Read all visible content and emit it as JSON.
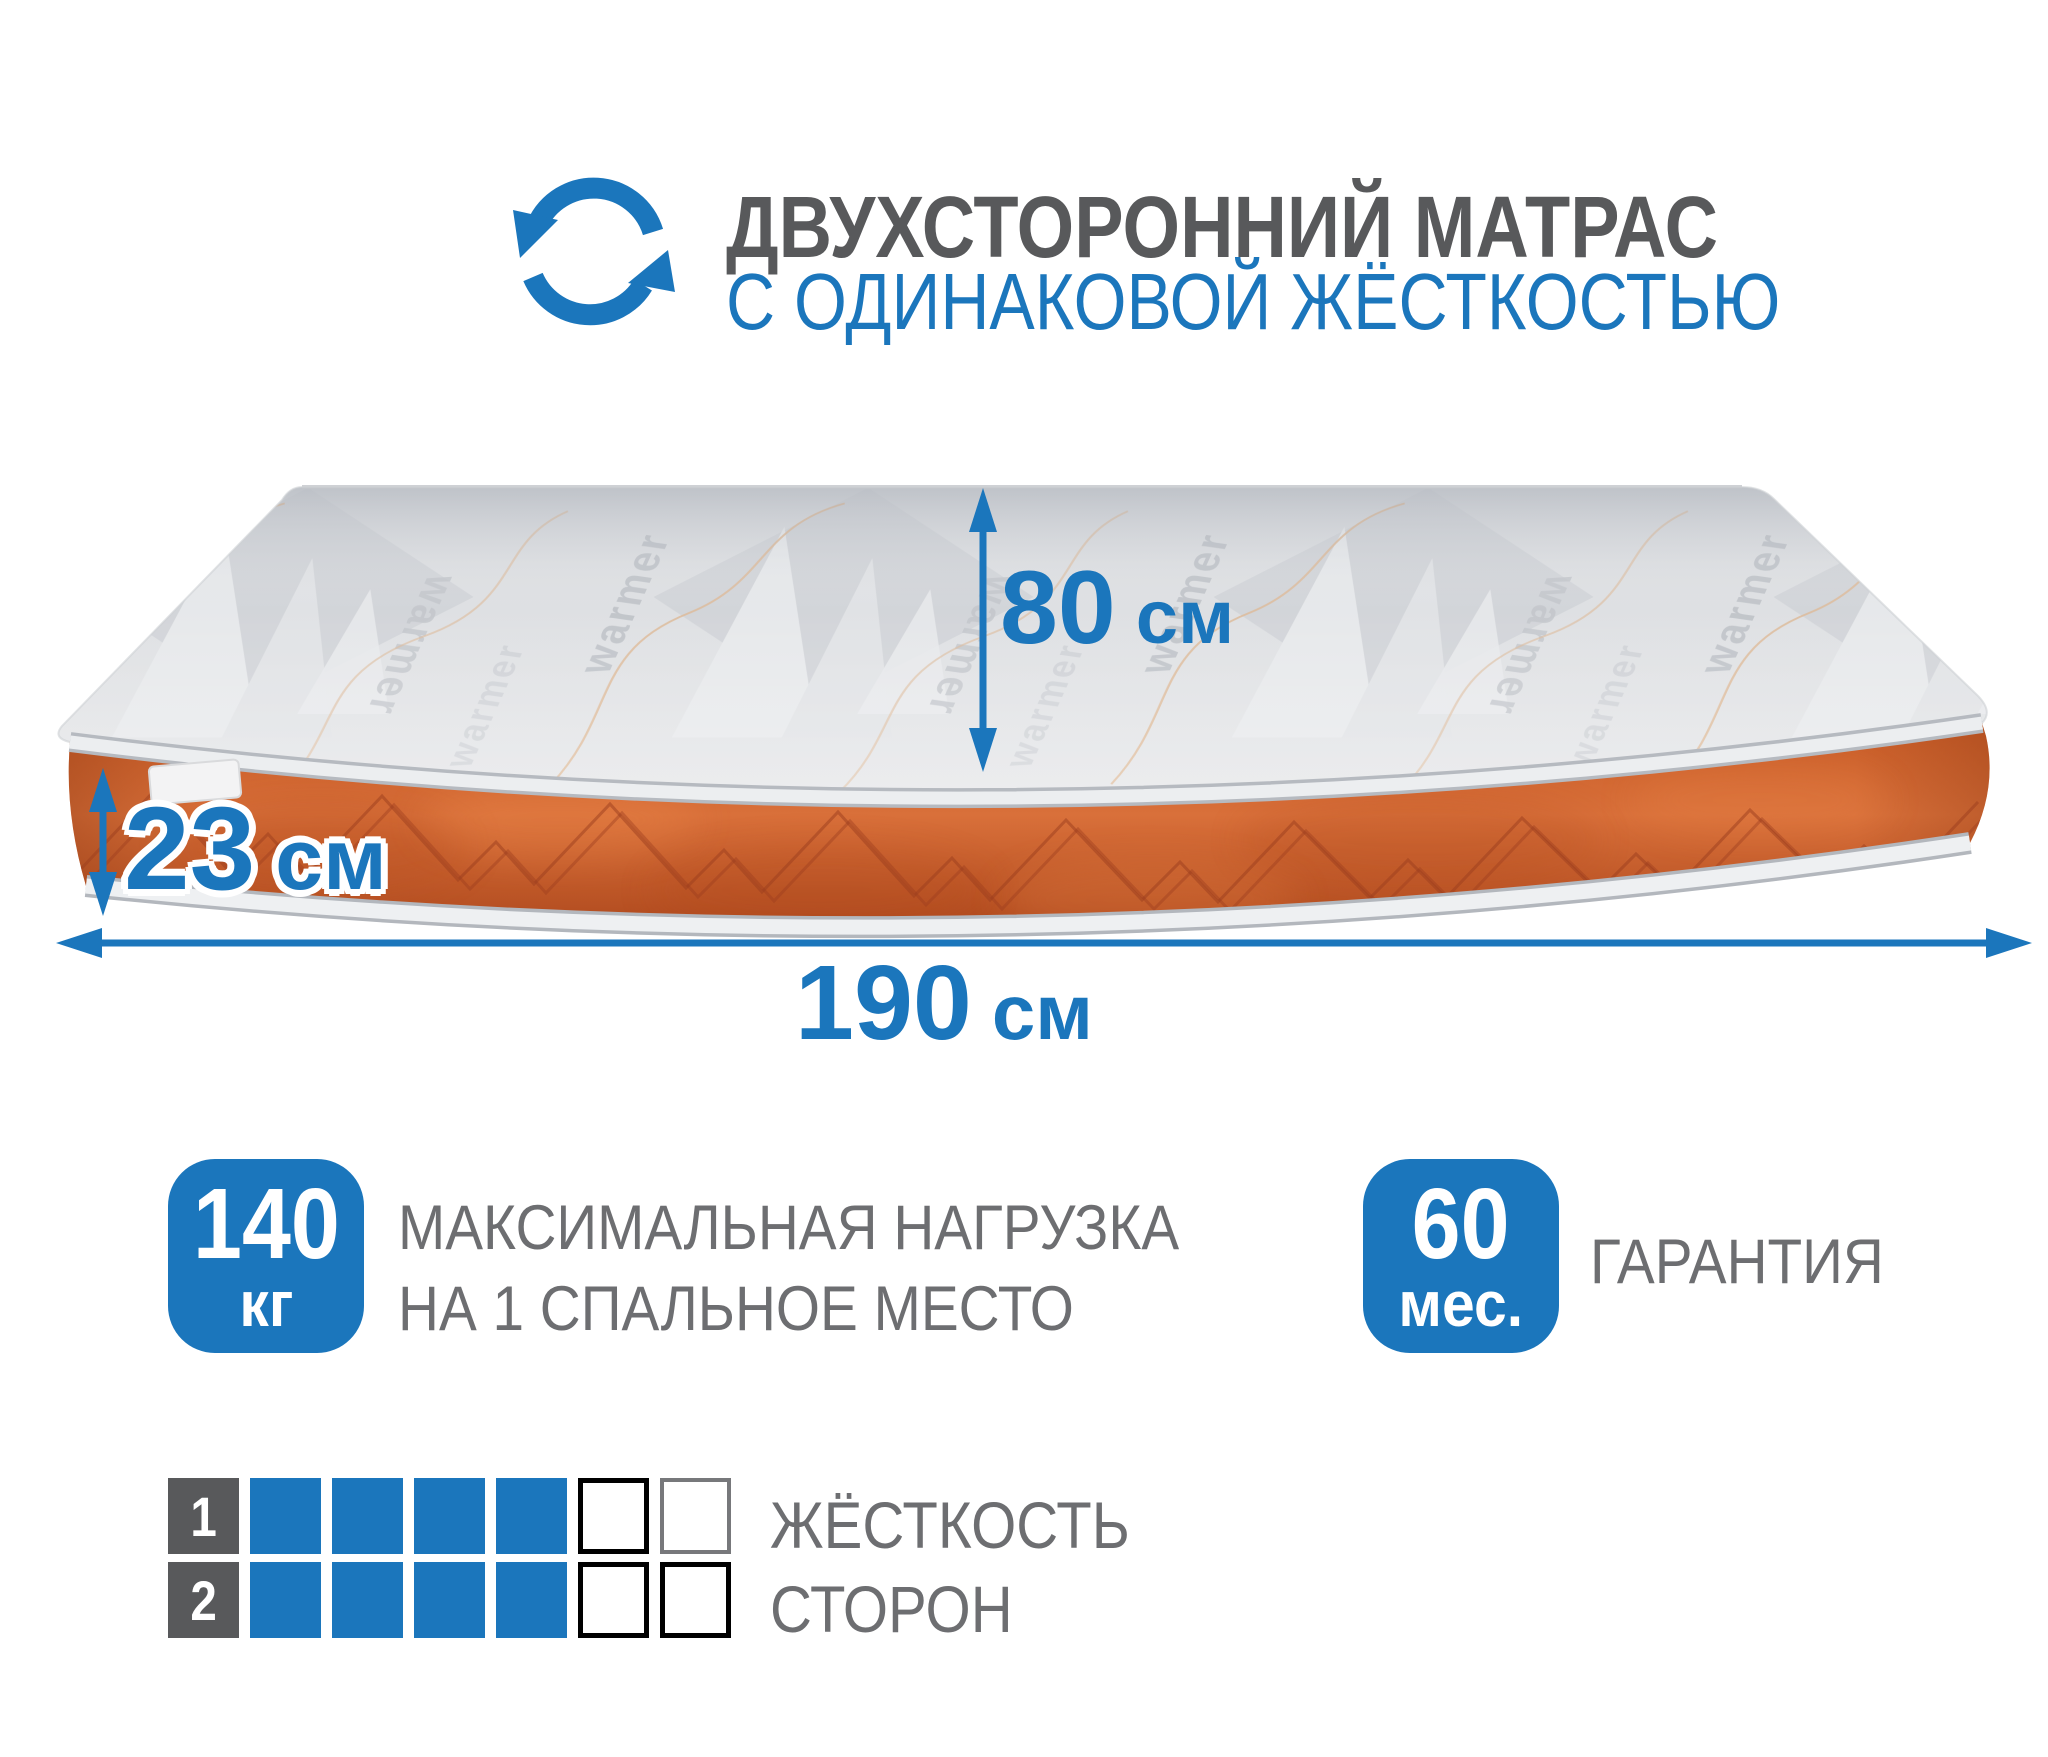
{
  "header": {
    "title": "ДВУХСТОРОННИЙ МАТРАС",
    "subtitle": "С ОДИНАКОВОЙ ЖЁСТКОСТЬЮ"
  },
  "dimensions": {
    "depth": {
      "value": "80",
      "unit": "см"
    },
    "height": {
      "value": "23",
      "unit": "см"
    },
    "length": {
      "value": "190",
      "unit": "см"
    }
  },
  "badges": [
    {
      "value": "140",
      "unit": "кг",
      "label_line1": "МАКСИМАЛЬНАЯ НАГРУЗКА",
      "label_line2": "НА 1 СПАЛЬНОЕ МЕСТО"
    },
    {
      "value": "60",
      "unit": "мес.",
      "label_line1": "ГАРАНТИЯ",
      "label_line2": ""
    }
  ],
  "firmness_scale": {
    "rows": [
      {
        "index": "1",
        "filled": 4,
        "empty": 2,
        "total": 6
      },
      {
        "index": "2",
        "filled": 4,
        "empty": 2,
        "total": 6
      }
    ],
    "label_line1": "ЖЁСТКОСТЬ",
    "label_line2": "СТОРОН"
  },
  "fabric_brand": "warmer",
  "colors": {
    "accent_blue": "#1B76BC",
    "title_gray": "#58595B",
    "text_gray": "#6D6E71",
    "mattress_top_gray": "#E0E2E5",
    "mattress_side_orange": "#D2622E"
  }
}
